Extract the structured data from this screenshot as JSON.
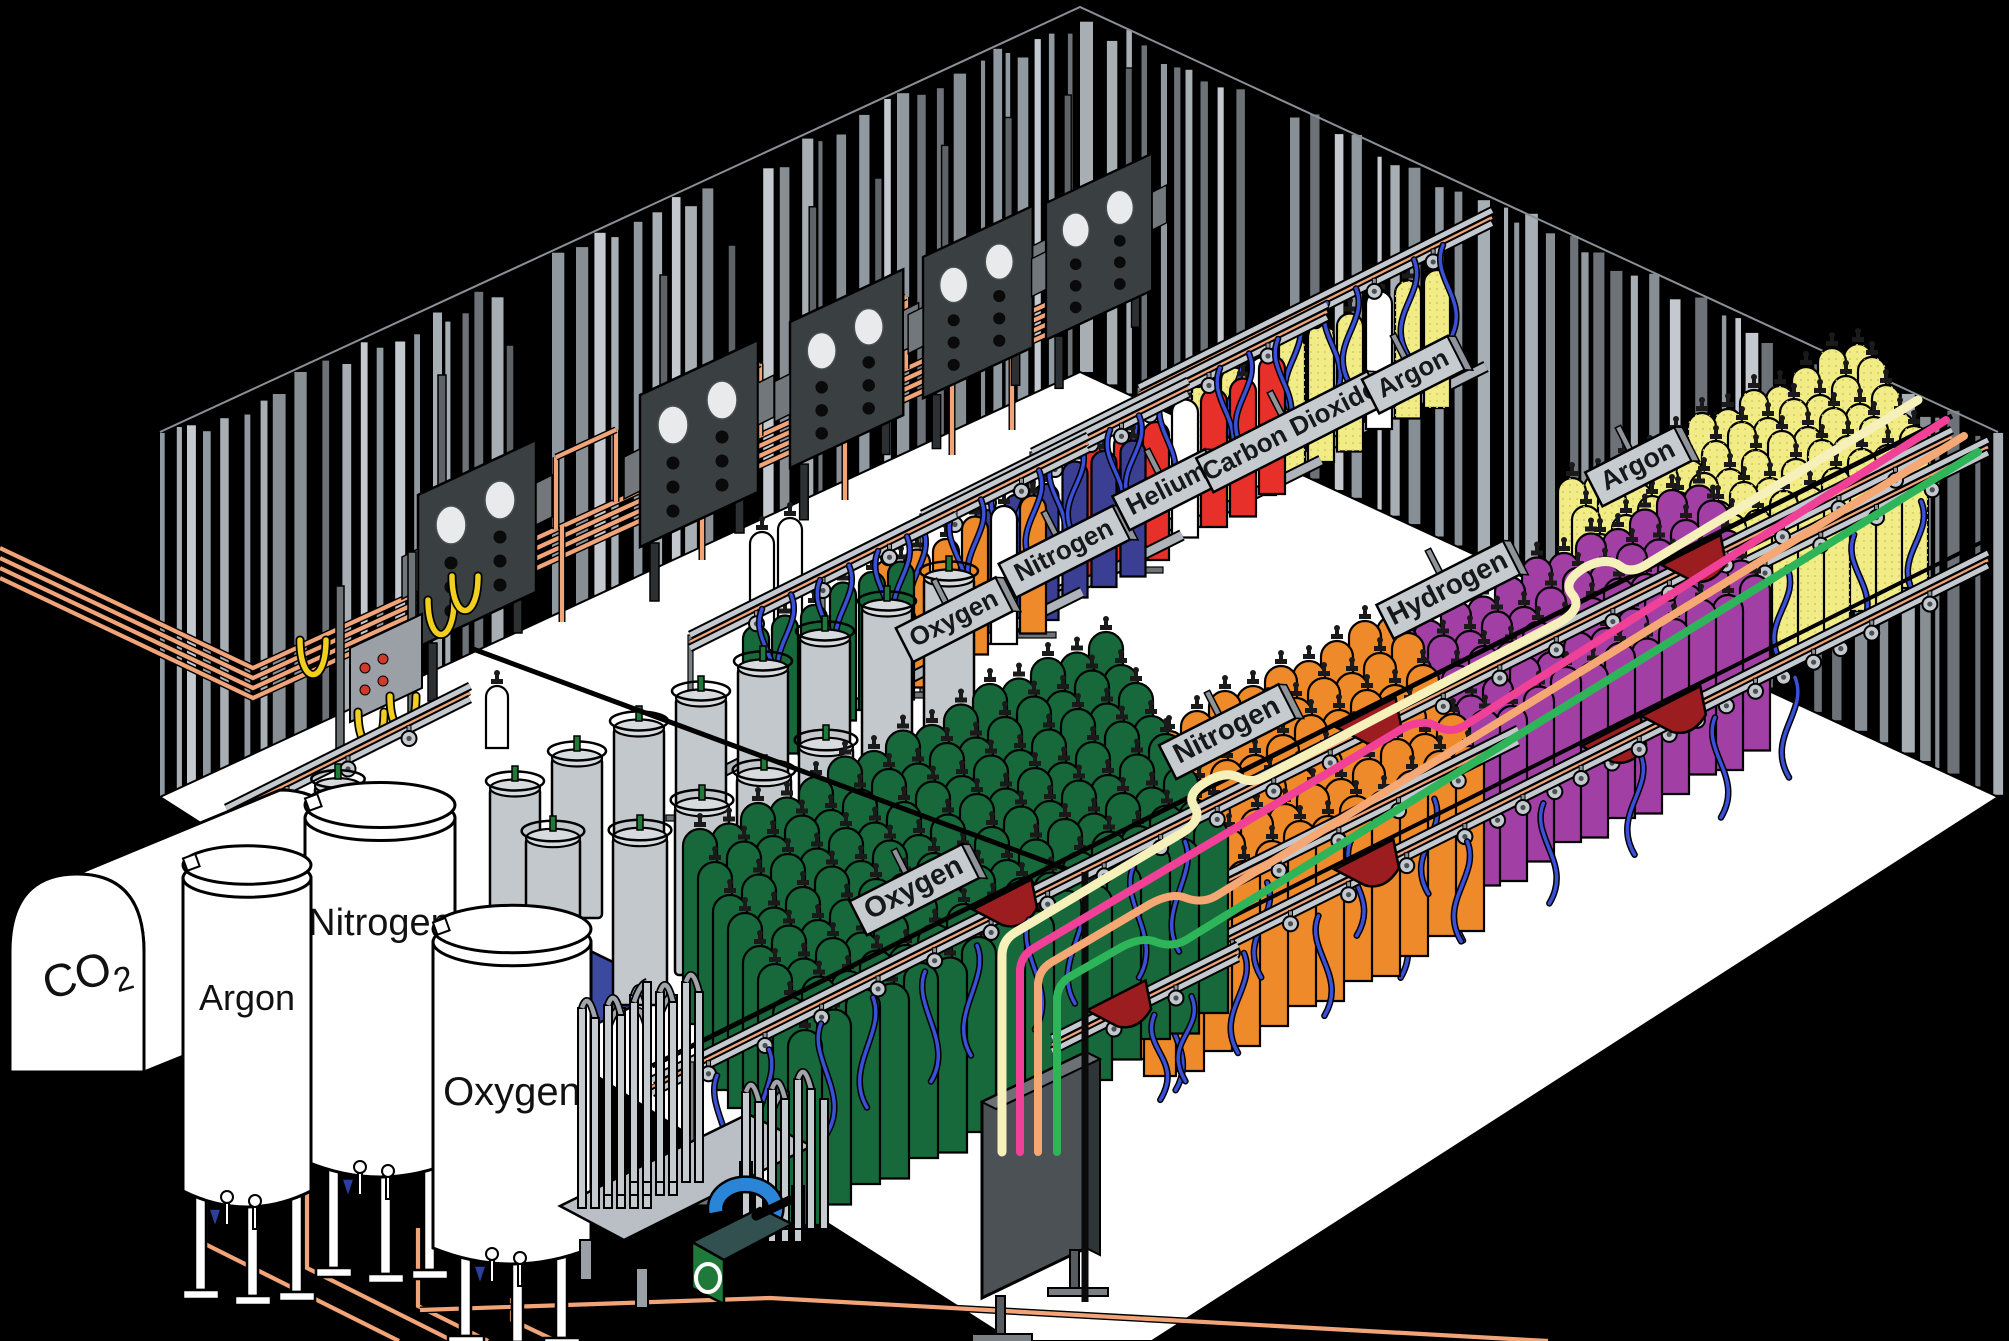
{
  "diagram": {
    "description": "Isometric cutaway illustration of an industrial gas cylinder filling plant",
    "background": "#000000",
    "floor_color": "#ffffff"
  },
  "storage_tanks": [
    {
      "label": "CO2",
      "kind": "horizontal bulk tank"
    },
    {
      "label": "Argon",
      "kind": "vertical bulk tank"
    },
    {
      "label": "Nitrogen",
      "kind": "vertical bulk tank"
    },
    {
      "label": "Oxygen",
      "kind": "vertical bulk tank"
    }
  ],
  "row_signs": [
    {
      "text": "Oxygen"
    },
    {
      "text": "Nitrogen"
    },
    {
      "text": "Helium"
    },
    {
      "text": "Carbon Dioxide"
    },
    {
      "text": "Argon"
    },
    {
      "text": "Oxygen"
    },
    {
      "text": "Nitrogen"
    },
    {
      "text": "Hydrogen"
    },
    {
      "text": "Argon"
    }
  ],
  "cylinder_groups": [
    {
      "gas": "Oxygen",
      "color_hex": "#17683A",
      "approx_count": 125
    },
    {
      "gas": "Nitrogen",
      "color_hex": "#EE8A2A",
      "approx_count": 70
    },
    {
      "gas": "Nitrogen",
      "color_hex": "#3A3F94",
      "approx_count": 6
    },
    {
      "gas": "Helium",
      "color_hex": "#E8302A",
      "approx_count": 7
    },
    {
      "gas": "Carbon Dioxide",
      "color_hex": "#F2EC86",
      "approx_count": 10
    },
    {
      "gas": "Hydrogen",
      "color_hex": "#A23FA5",
      "approx_count": 60
    },
    {
      "gas": "Argon",
      "color_hex": "#F2EC86",
      "approx_count": 60
    }
  ],
  "transfer_lines": [
    {
      "name": "cream",
      "color_hex": "#F6F0BB"
    },
    {
      "name": "pink",
      "color_hex": "#F04098"
    },
    {
      "name": "peach",
      "color_hex": "#F5A874"
    },
    {
      "name": "green",
      "color_hex": "#2FB559"
    }
  ],
  "equipment": {
    "manifold_panel_count": 5,
    "dewar_count": 14,
    "vaporizers": 2,
    "pump": 1,
    "distribution_panel": 1
  },
  "palette": {
    "copper_pipe": "#F0A478",
    "rail_gray": "#C3C9CE",
    "hose_blue": "#3A50D6",
    "hose_yellow": "#F2CF1E",
    "tray_red": "#9C1D20",
    "sign_plate": "#C6CBCF",
    "panel_dark": "#3A3F42",
    "wall_stripes": [
      "#878E94",
      "#A7AEB4",
      "#C3C9CE",
      "#6C7278",
      "#9098A0"
    ]
  }
}
